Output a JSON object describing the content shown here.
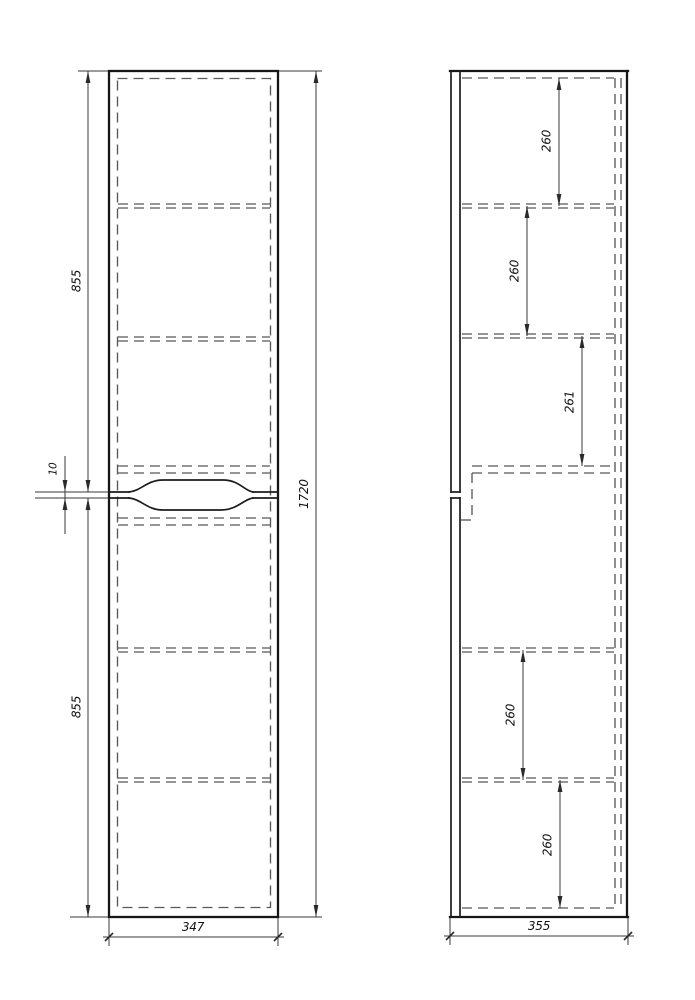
{
  "drawing": {
    "type": "technical-drawing",
    "views": {
      "front": {
        "label": "front-view",
        "dims": {
          "upper_height": "855",
          "lower_height": "855",
          "gap": "10",
          "total_height": "1720",
          "width": "347"
        }
      },
      "side": {
        "label": "side-view",
        "dims": {
          "section_1": "260",
          "section_2": "260",
          "section_3": "261",
          "section_4": "260",
          "section_5": "260",
          "depth": "355"
        }
      }
    },
    "colors": {
      "background": "#ffffff",
      "outline": "#161616",
      "hidden_line": "#585858",
      "dimension_line": "#3a3a3a",
      "text": "#111111"
    }
  }
}
